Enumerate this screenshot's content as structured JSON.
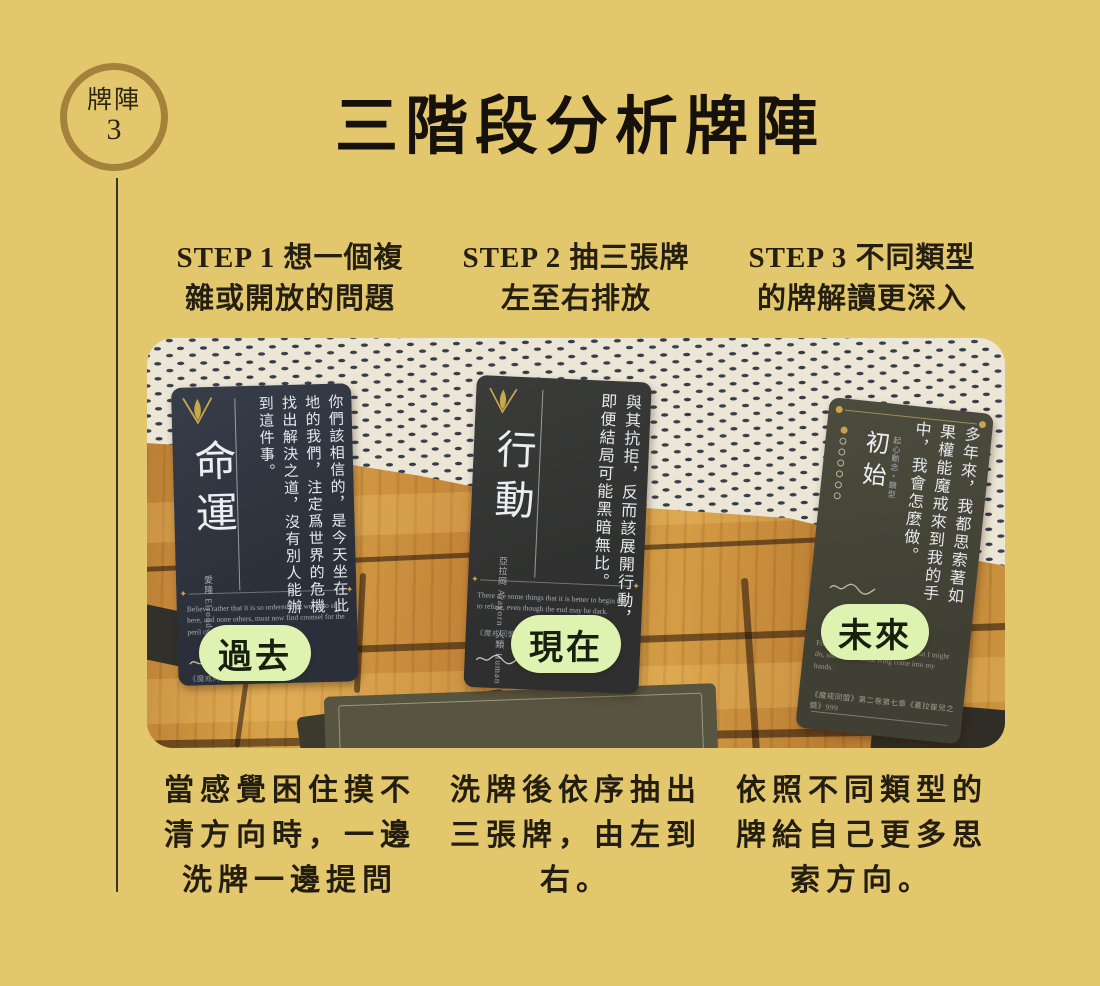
{
  "badge": {
    "label": "牌陣",
    "number": "3"
  },
  "title": "三階段分析牌陣",
  "steps": [
    {
      "lines": [
        "STEP 1 想一個複",
        "雜或開放的問題"
      ]
    },
    {
      "lines": [
        "STEP 2 抽三張牌",
        "左至右排放"
      ]
    },
    {
      "lines": [
        "STEP 3 不同類型",
        "的牌解讀更深入"
      ]
    }
  ],
  "captions": [
    {
      "lines": [
        "當感覺困住摸不",
        "清方向時，一邊",
        "洗牌一邊提問"
      ]
    },
    {
      "lines": [
        "洗牌後依序抽出",
        "三張牌，由左到",
        "右。"
      ]
    },
    {
      "lines": [
        "依照不同類型的",
        "牌給自己更多思",
        "索方向。"
      ]
    }
  ],
  "cards": [
    {
      "title": "命運",
      "subtitle": "愛隆 Elrond",
      "quote": "你們該相信的，是今天坐在此地的我們，注定爲世界的危機找出解決之道，沒有別人能辦到這件事。",
      "quote_en": "Believe rather that it is so ordered that we, who sit here, and none others, must now find counsel for the peril of the world.",
      "footer": "《魔戒同盟》",
      "label": "過去"
    },
    {
      "title": "行動",
      "subtitle": "亞拉岡 Aragorn 人類 Human",
      "quote": "與其抗拒，反而該展開行動，即便結局可能黑暗無比。",
      "quote_en": "There are some things that it is better to begin than to refuse, even though the end may be dark.",
      "footer": "《魔戒同盟》第…",
      "label": "現在"
    },
    {
      "title": "初始",
      "subtitle": "起心動念・類型",
      "quote": "多年來，我都思索著如果權能魔戒來到我的手中，我會怎麼做。",
      "quote_en": "For many years I had pondered what I might do, should the Great Ring come into my hands.",
      "footer": "《魔戒同盟》第二卷第七章《蓋拉崔兒之鏡》999",
      "label": "未來"
    }
  ],
  "icons": {
    "diamond": "✦"
  },
  "colors": {
    "background": "#e3c76c",
    "badge_ring": "#a5823a",
    "card_navy": "#2e3340",
    "card_olive": "#46463a",
    "pill_green": "#def2b2",
    "gold": "#c9a44c",
    "wood": "#c98e3b",
    "blanket": "#ece6d6"
  }
}
